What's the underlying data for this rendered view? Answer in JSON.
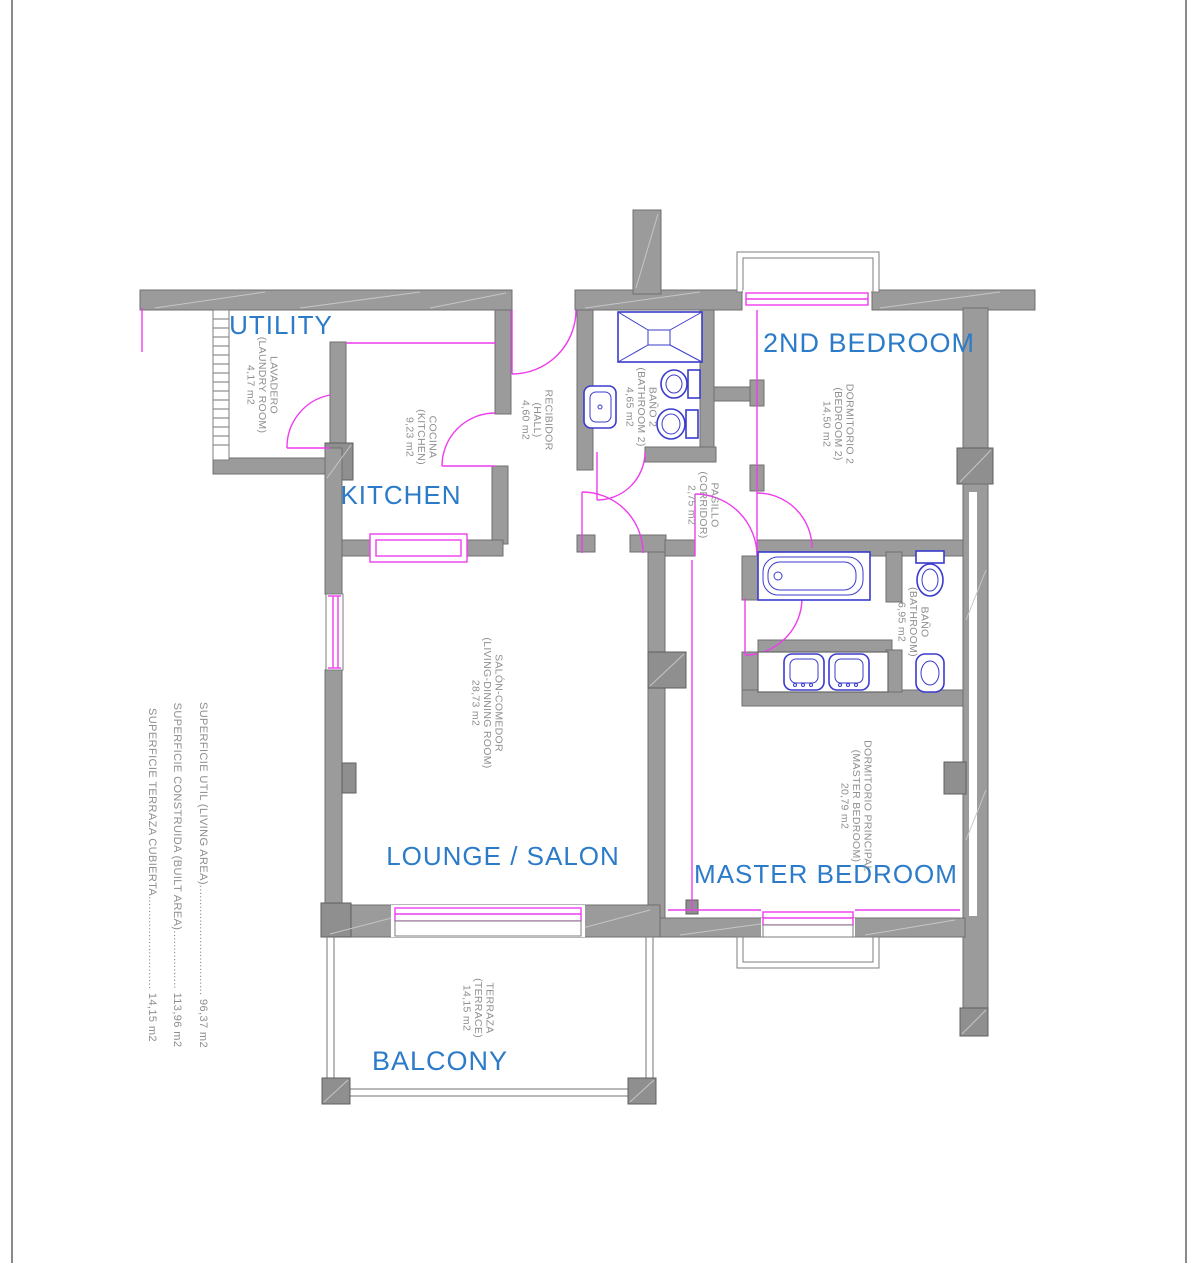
{
  "drawing": {
    "type": "apartment floor plan",
    "colors": {
      "wall_gray": "#9b9b9b",
      "room_label_blue": "#2b7bc9",
      "annotation_gray": "#8f8f8f",
      "fixture_blue": "#3b3bce",
      "door_window_pink": "#ee3cee"
    }
  },
  "rooms": {
    "utility": {
      "label": "UTILITY",
      "name": "LAVADERO",
      "name_en": "(LAUNDRY ROOM)",
      "area": "4,17 m2"
    },
    "kitchen": {
      "label": "KITCHEN",
      "name": "COCINA",
      "name_en": "(KITCHEN)",
      "area": "9,23 m2"
    },
    "hall": {
      "name": "RECIBIDOR",
      "name_en": "(HALL)",
      "area": "4,60 m2"
    },
    "bathroom2": {
      "name": "BAÑO 2",
      "name_en": "(BATHROOM 2)",
      "area": "4,65 m2"
    },
    "bedroom2": {
      "label": "2ND BEDROOM",
      "name": "DORMITORIO 2",
      "name_en": "(BEDROOM 2)",
      "area": "14,50 m2"
    },
    "corridor": {
      "name": "PASILLO",
      "name_en": "(CORRIDOR)",
      "area": "2,75 m2"
    },
    "bathroom": {
      "name": "BAÑO",
      "name_en": "(BATHROOM)",
      "area": "6,95 m2"
    },
    "lounge": {
      "label": "LOUNGE / SALON",
      "name": "SALÓN-COMEDOR",
      "name_en": "(LIVING-DINNING ROOM)",
      "area": "28,73 m2"
    },
    "master": {
      "label": "MASTER BEDROOM",
      "name": "DORMITORIO PRINCIPAL",
      "name_en": "(MASTER BEDROOM)",
      "area": "20,79 m2"
    },
    "balcony": {
      "label": "BALCONY",
      "name": "TERRAZA",
      "name_en": "(TERRACE)",
      "area": "14,15 m2"
    }
  },
  "summary": {
    "living": "SUPERFICIE UTIL (LIVING AREA)................................ 96,37 m2",
    "built": "SUPERFICIE CONSTRUIDA (BUILT AREA)................. 113,96 m2",
    "terrace": "SUPERFICIE TERRAZA CUBIERTA........................... 14,15 m2"
  }
}
